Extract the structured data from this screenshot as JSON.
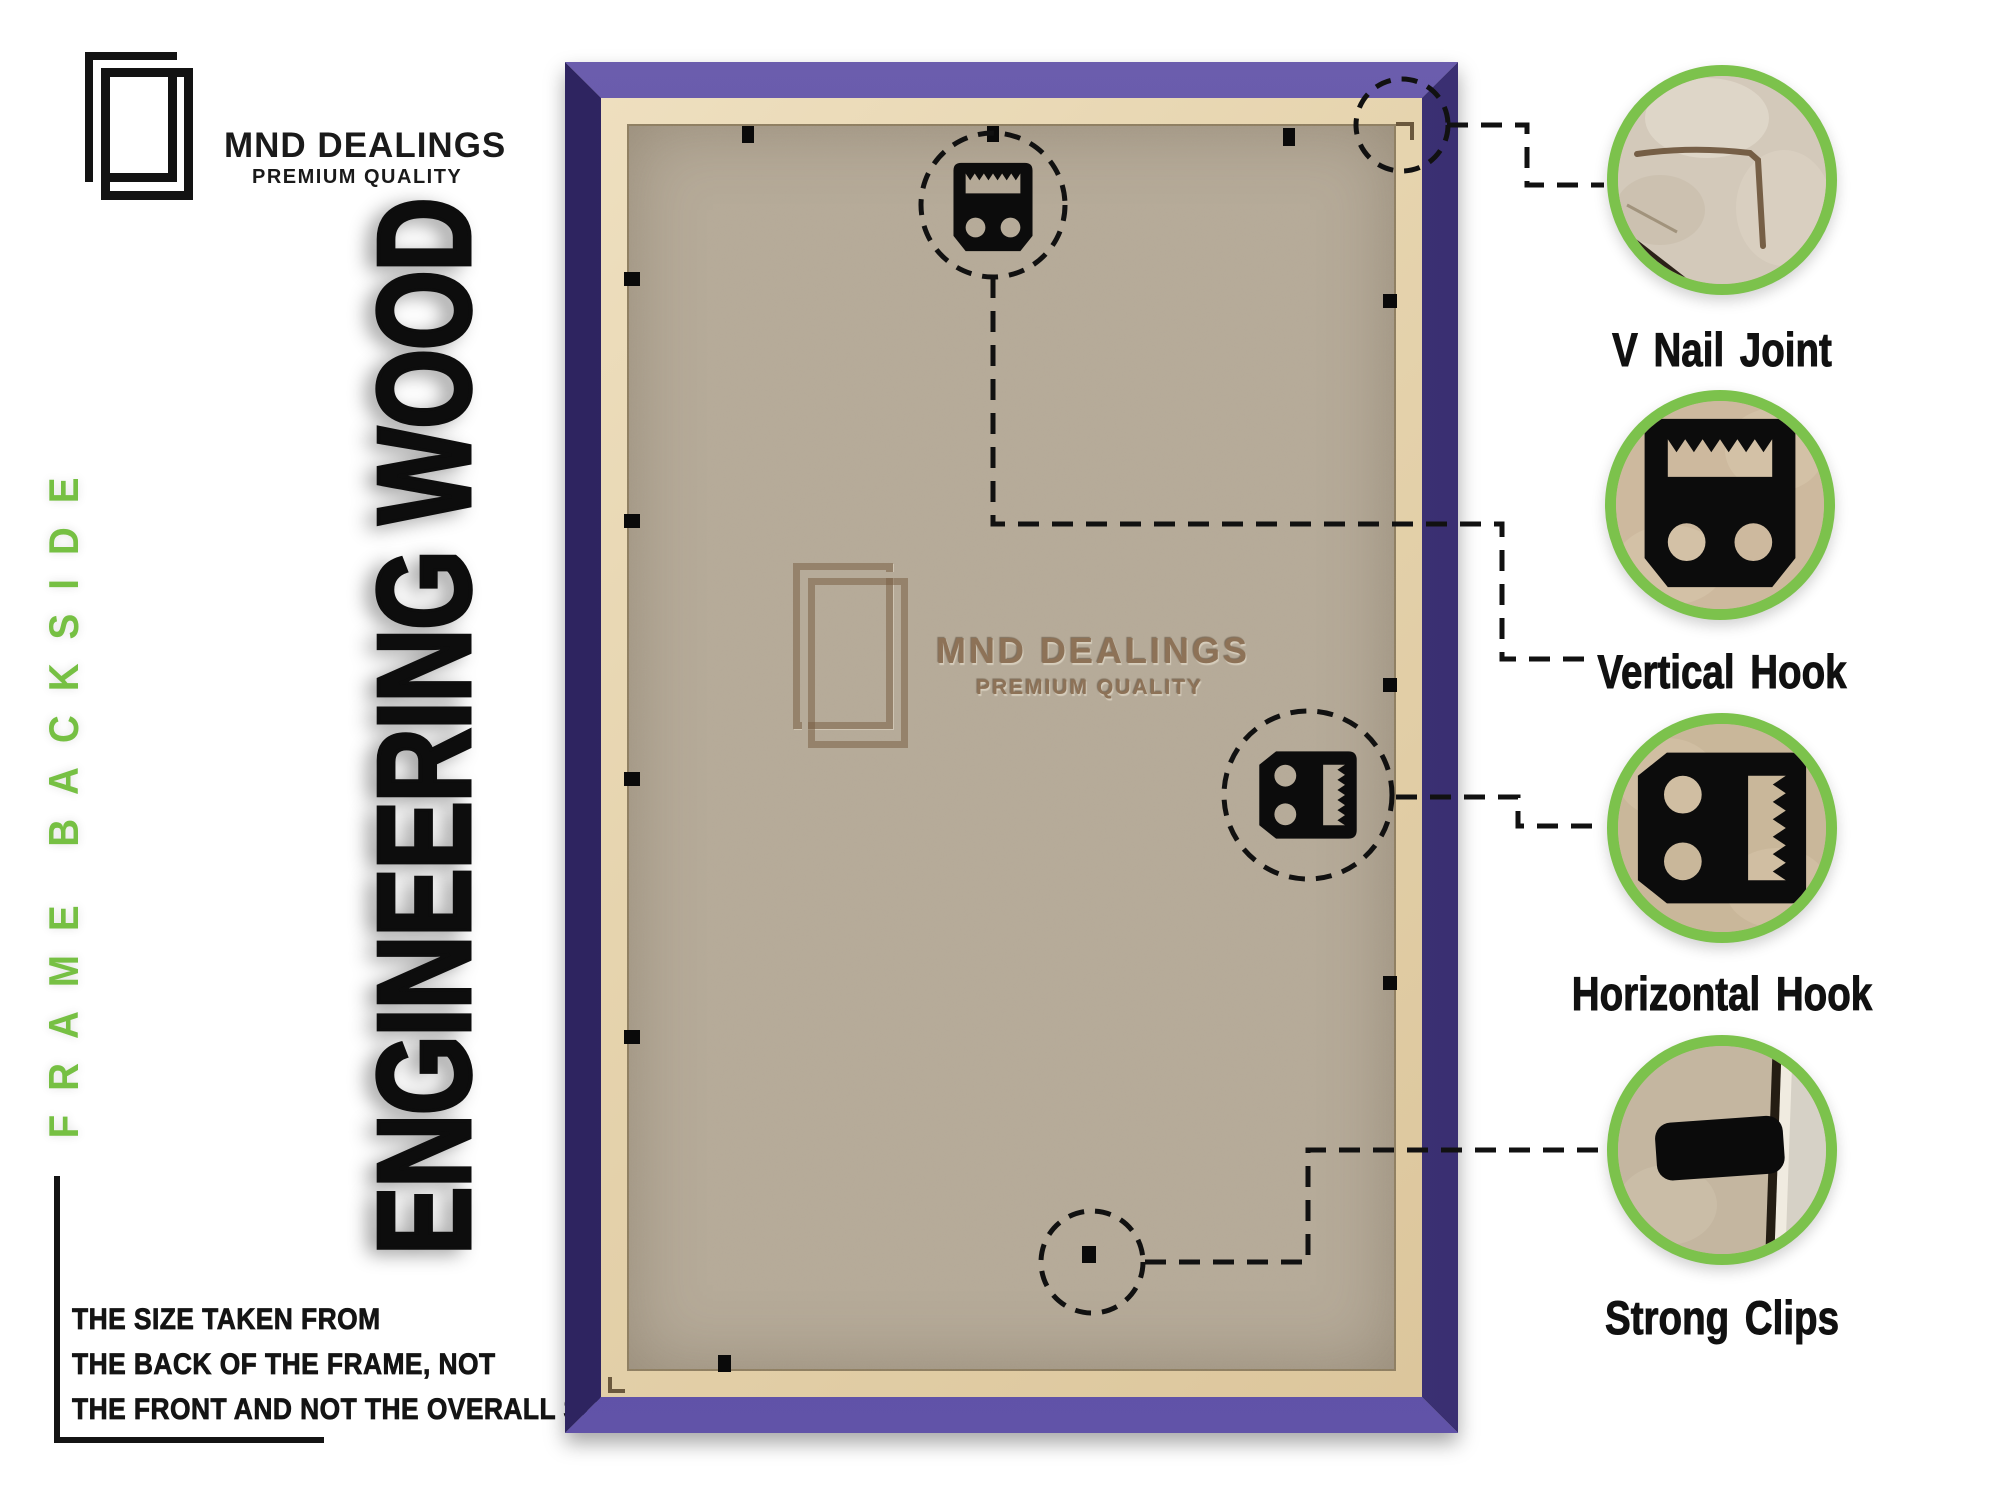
{
  "brand": {
    "name": "MND DEALINGS",
    "tagline": "PREMIUM QUALITY"
  },
  "labels": {
    "side_vertical": "FRAME BACKSIDE",
    "material_vertical": "ENGINEERING WOOD"
  },
  "size_note": {
    "lines": [
      "THE SIZE TAKEN FROM",
      "THE BACK OF THE FRAME, NOT",
      "THE FRONT AND NOT THE OVERALL SIZE."
    ]
  },
  "watermark": {
    "name": "MND DEALINGS",
    "tagline": "PREMIUM QUALITY"
  },
  "callouts": {
    "items": [
      {
        "label": "V Nail Joint",
        "icon": "v-nail-joint-photo"
      },
      {
        "label": "Vertical Hook",
        "icon": "vertical-hook-photo"
      },
      {
        "label": "Horizontal Hook",
        "icon": "horizontal-hook-photo"
      },
      {
        "label": "Strong Clips",
        "icon": "strong-clips-photo"
      }
    ]
  },
  "colors": {
    "accent_green": "#76C043",
    "frame_purple": "#4E4189",
    "frame_purple_dark": "#2E2460",
    "frame_purple_light": "#6153A8",
    "mdf_panel": "#B6AB99",
    "mdf_edge_tan": "#E8D7B4",
    "hardware_black": "#0C0C0C",
    "leader_line": "#111111",
    "watermark_brown": "#8D7257"
  }
}
